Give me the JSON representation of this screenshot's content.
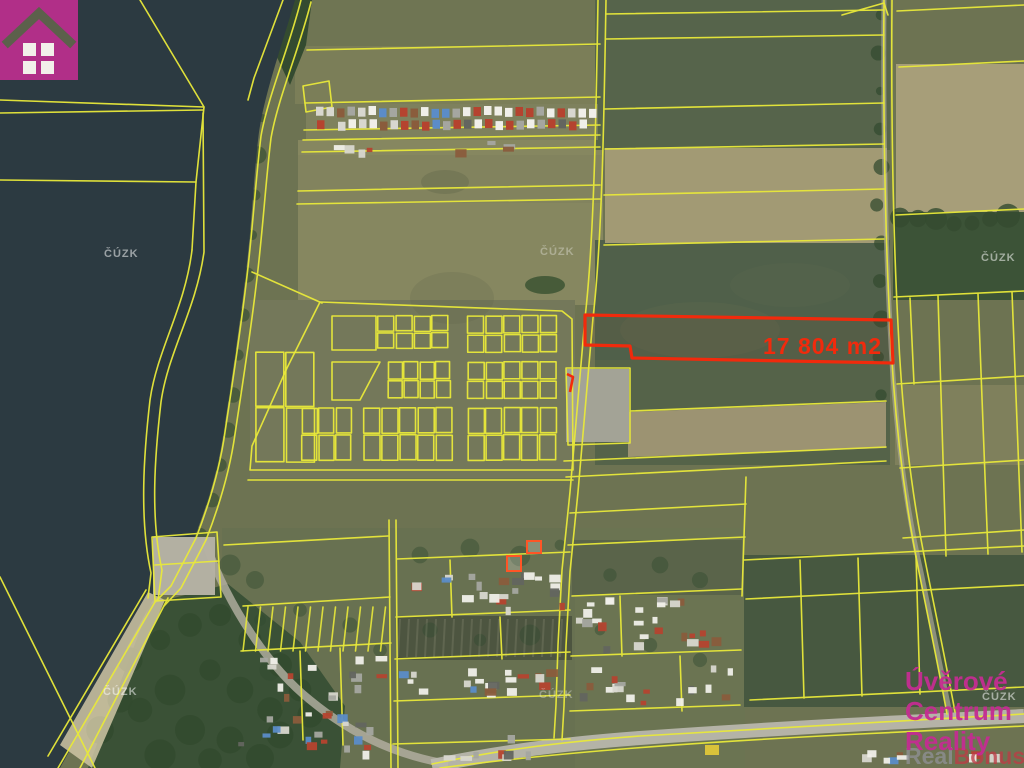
{
  "map": {
    "provider": "ČÚZK",
    "highlight": {
      "area_label": "17 804 m2",
      "color": "#f12a0c"
    },
    "colors": {
      "water": "#2c3a41",
      "land": "#6d7352",
      "line": "#e9e93a",
      "red": "#f12a0c",
      "watermark": "#ffffff",
      "forest": "#344b30",
      "house_palette": [
        "#f0efe9",
        "#d8d7cf",
        "#a5a6a0",
        "#b5432f",
        "#5b8cc8",
        "#63655f",
        "#8a5c3c"
      ]
    }
  },
  "logo": {
    "name1": "Úvěrové",
    "name2": "Centrum",
    "name3": "Reality",
    "brand_color": "#c42d92",
    "watermark_real": "Real",
    "watermark_bonus": "Bonus",
    "watermark_cz": ".cz"
  }
}
